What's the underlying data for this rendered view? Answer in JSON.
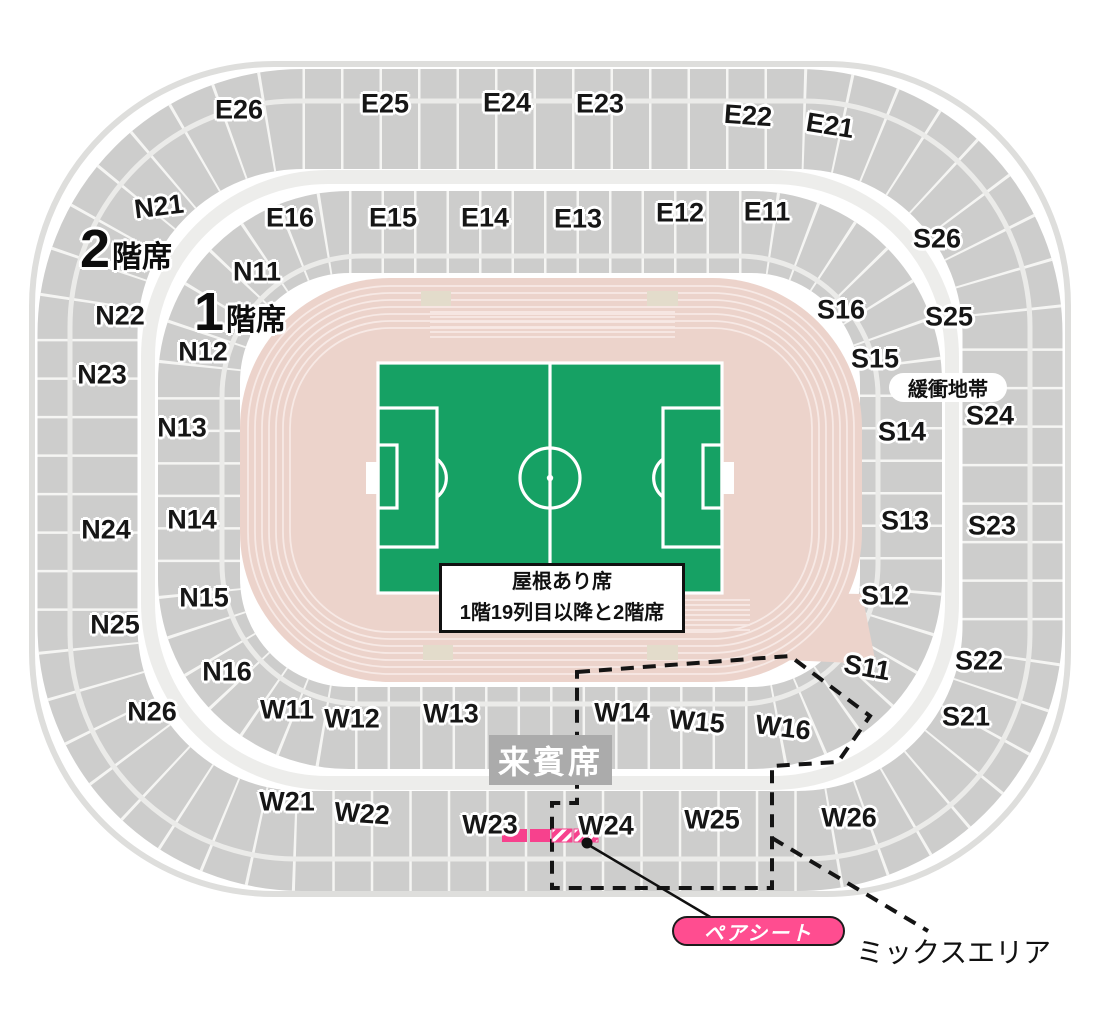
{
  "map": {
    "tier2_label": {
      "number": "2",
      "suffix": "階席"
    },
    "tier1_label": {
      "number": "1",
      "suffix": "階席"
    },
    "buffer_zone_label": "緩衝地帯",
    "roof_note": {
      "line1": "屋根あり席",
      "line2": "1階19列目以降と2階席"
    },
    "vip_label": "来賓席",
    "pair_seat_label": "ペアシート",
    "mix_area_label": "ミックスエリア"
  },
  "sections": {
    "east_upper": [
      "E26",
      "E25",
      "E24",
      "E23",
      "E22",
      "E21"
    ],
    "east_lower": [
      "E16",
      "E15",
      "E14",
      "E13",
      "E12",
      "E11"
    ],
    "north_upper": [
      "N21",
      "N22",
      "N23",
      "N24",
      "N25",
      "N26"
    ],
    "north_lower": [
      "N11",
      "N12",
      "N13",
      "N14",
      "N15",
      "N16"
    ],
    "south_upper": [
      "S26",
      "S25",
      "S24",
      "S23",
      "S22",
      "S21"
    ],
    "south_lower": [
      "S16",
      "S15",
      "S14",
      "S13",
      "S12",
      "S11"
    ],
    "west_upper": [
      "W21",
      "W22",
      "W23",
      "W24",
      "W25",
      "W26"
    ],
    "west_lower": [
      "W11",
      "W12",
      "W13",
      "W14",
      "W15",
      "W16"
    ]
  },
  "colors": {
    "field_green": "#16a164",
    "track_pink": "#ecd3cb",
    "seat_gray": "#cdcdcc",
    "vip_gray": "#ababab",
    "highlight_pink": "#f7418d",
    "pair_pill_pink": "#ff4d90"
  }
}
